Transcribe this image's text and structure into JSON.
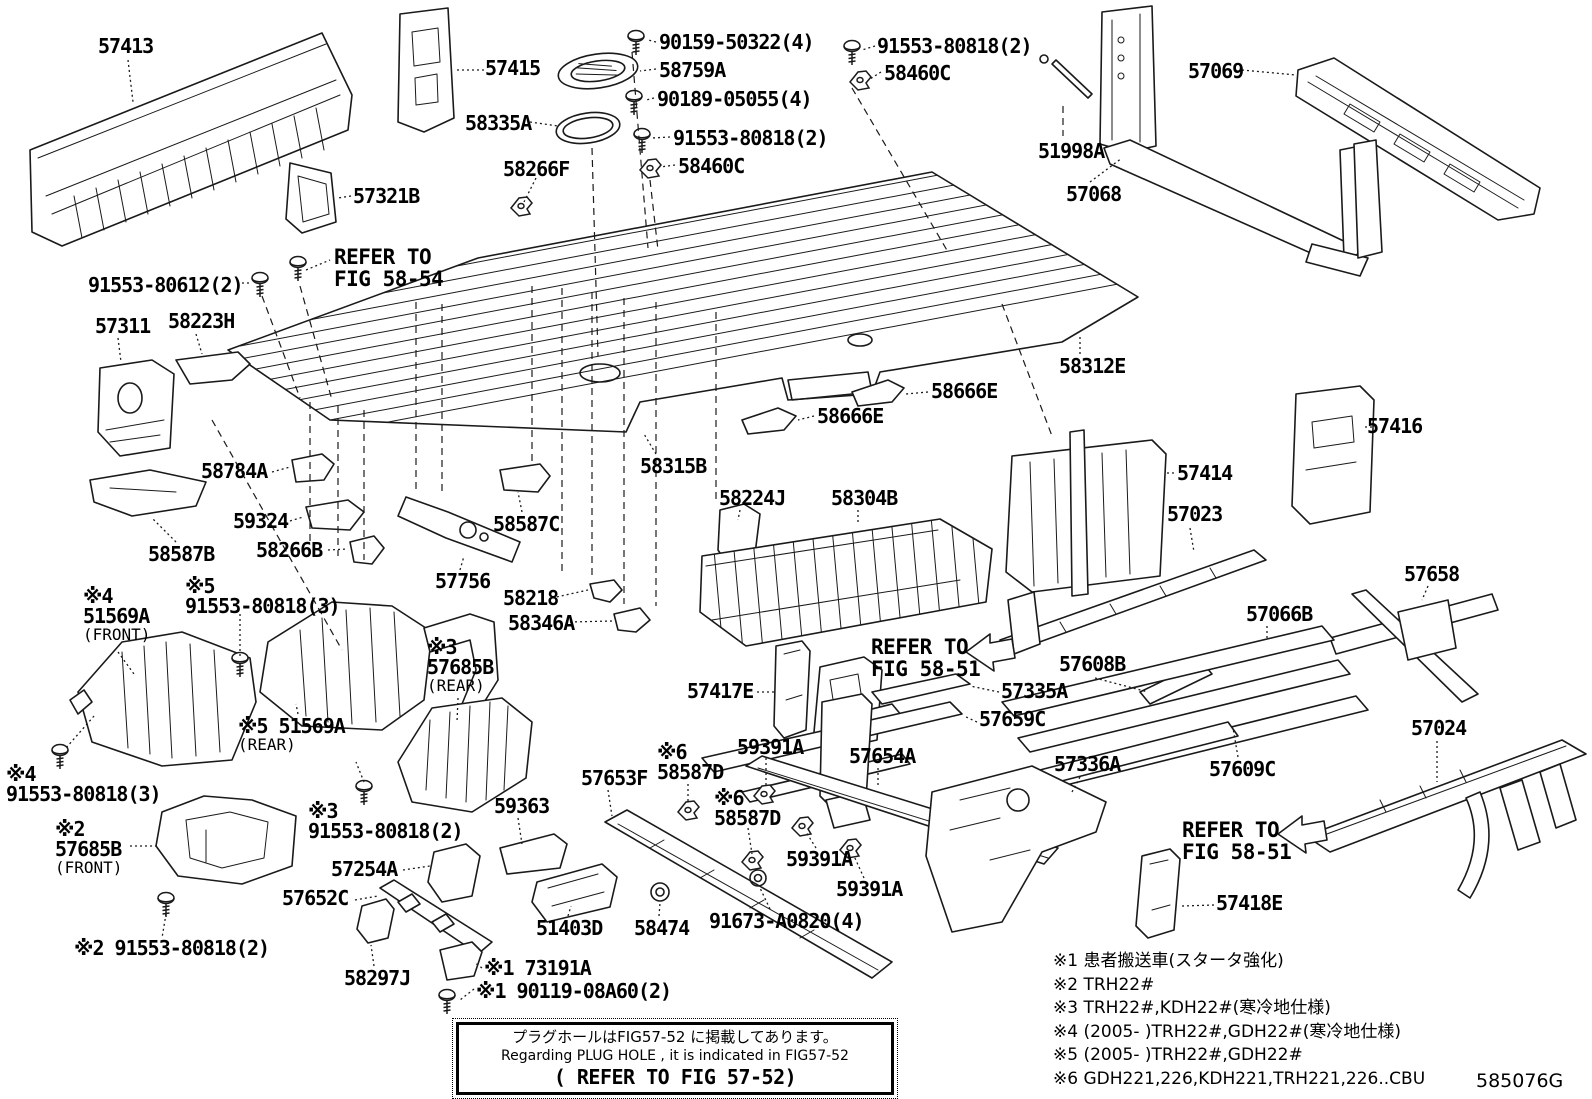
{
  "figure": {
    "code": "585076G"
  },
  "style": {
    "line_color": "#1a1a1a",
    "background": "#ffffff",
    "text_color": "#000000"
  },
  "callouts": [
    {
      "id": "57413",
      "lines": [
        "57413"
      ],
      "x": 98,
      "y": 36
    },
    {
      "id": "57415",
      "lines": [
        "57415"
      ],
      "x": 485,
      "y": 58
    },
    {
      "id": "90159-50322",
      "lines": [
        "90159-50322(4)"
      ],
      "x": 659,
      "y": 32
    },
    {
      "id": "58759A",
      "lines": [
        "58759A"
      ],
      "x": 659,
      "y": 60
    },
    {
      "id": "90189-05055",
      "lines": [
        "90189-05055(4)"
      ],
      "x": 657,
      "y": 89
    },
    {
      "id": "91553-80818-mid",
      "lines": [
        "91553-80818(2)"
      ],
      "x": 673,
      "y": 128
    },
    {
      "id": "58460C-mid",
      "lines": [
        "58460C"
      ],
      "x": 678,
      "y": 156
    },
    {
      "id": "91553-80818-tr",
      "lines": [
        "91553-80818(2)"
      ],
      "x": 877,
      "y": 36
    },
    {
      "id": "58460C-tr",
      "lines": [
        "58460C"
      ],
      "x": 884,
      "y": 63
    },
    {
      "id": "58335A",
      "lines": [
        "58335A"
      ],
      "x": 465,
      "y": 113
    },
    {
      "id": "58266F",
      "lines": [
        "58266F"
      ],
      "x": 503,
      "y": 159
    },
    {
      "id": "57321B",
      "lines": [
        "57321B"
      ],
      "x": 353,
      "y": 186
    },
    {
      "id": "57069",
      "lines": [
        "57069"
      ],
      "x": 1188,
      "y": 61
    },
    {
      "id": "51998A",
      "lines": [
        "51998A"
      ],
      "x": 1038,
      "y": 141
    },
    {
      "id": "57068",
      "lines": [
        "57068"
      ],
      "x": 1066,
      "y": 184
    },
    {
      "id": "91553-80612",
      "lines": [
        "91553-80612(2)"
      ],
      "x": 88,
      "y": 275
    },
    {
      "id": "57311",
      "lines": [
        "57311"
      ],
      "x": 95,
      "y": 316
    },
    {
      "id": "58223H",
      "lines": [
        "58223H"
      ],
      "x": 168,
      "y": 311
    },
    {
      "id": "58784A",
      "lines": [
        "58784A"
      ],
      "x": 201,
      "y": 461
    },
    {
      "id": "59324",
      "lines": [
        "59324"
      ],
      "x": 233,
      "y": 511
    },
    {
      "id": "58587B",
      "lines": [
        "58587B"
      ],
      "x": 148,
      "y": 544
    },
    {
      "id": "58266B",
      "lines": [
        "58266B"
      ],
      "x": 256,
      "y": 540
    },
    {
      "id": "58587C",
      "lines": [
        "58587C"
      ],
      "x": 493,
      "y": 514
    },
    {
      "id": "57756",
      "lines": [
        "57756"
      ],
      "x": 435,
      "y": 571
    },
    {
      "id": "58218",
      "lines": [
        "58218"
      ],
      "x": 503,
      "y": 588
    },
    {
      "id": "58346A",
      "lines": [
        "58346A"
      ],
      "x": 508,
      "y": 613
    },
    {
      "id": "58315B",
      "lines": [
        "58315B"
      ],
      "x": 640,
      "y": 456
    },
    {
      "id": "58666E-a",
      "lines": [
        "58666E"
      ],
      "x": 931,
      "y": 381
    },
    {
      "id": "58666E-b",
      "lines": [
        "58666E"
      ],
      "x": 817,
      "y": 406
    },
    {
      "id": "58312E",
      "lines": [
        "58312E"
      ],
      "x": 1059,
      "y": 356
    },
    {
      "id": "57416",
      "lines": [
        "57416"
      ],
      "x": 1367,
      "y": 416
    },
    {
      "id": "57414",
      "lines": [
        "57414"
      ],
      "x": 1177,
      "y": 463
    },
    {
      "id": "58224J",
      "lines": [
        "58224J"
      ],
      "x": 719,
      "y": 488
    },
    {
      "id": "58304B",
      "lines": [
        "58304B"
      ],
      "x": 831,
      "y": 488
    },
    {
      "id": "57023",
      "lines": [
        "57023"
      ],
      "x": 1167,
      "y": 504
    },
    {
      "id": "57066B",
      "lines": [
        "57066B"
      ],
      "x": 1246,
      "y": 604
    },
    {
      "id": "57658",
      "lines": [
        "57658"
      ],
      "x": 1404,
      "y": 564
    },
    {
      "id": "51569A-front",
      "lines": [
        "※4",
        "51569A",
        "(FRONT)"
      ],
      "x": 83,
      "y": 586
    },
    {
      "id": "91553-80818-3-mid",
      "lines": [
        "※5",
        "91553-80818(3)"
      ],
      "x": 185,
      "y": 576
    },
    {
      "id": "57685B-rear",
      "lines": [
        "※3",
        "57685B",
        "(REAR)"
      ],
      "x": 427,
      "y": 637
    },
    {
      "id": "51569A-rear",
      "lines": [
        "※5 51569A",
        "(REAR)"
      ],
      "x": 238,
      "y": 716
    },
    {
      "id": "91553-80818-3-bl",
      "lines": [
        "※4",
        "91553-80818(3)"
      ],
      "x": 6,
      "y": 764
    },
    {
      "id": "57685B-front",
      "lines": [
        "※2",
        "57685B",
        "(FRONT)"
      ],
      "x": 55,
      "y": 819
    },
    {
      "id": "91553-80818-2-b3",
      "lines": [
        "※3",
        "91553-80818(2)"
      ],
      "x": 308,
      "y": 801
    },
    {
      "id": "91553-80818-2-b2",
      "lines": [
        "※2 91553-80818(2)"
      ],
      "x": 74,
      "y": 938
    },
    {
      "id": "57254A",
      "lines": [
        "57254A"
      ],
      "x": 331,
      "y": 859
    },
    {
      "id": "57652C",
      "lines": [
        "57652C"
      ],
      "x": 282,
      "y": 888
    },
    {
      "id": "58297J",
      "lines": [
        "58297J"
      ],
      "x": 344,
      "y": 968
    },
    {
      "id": "73191A",
      "lines": [
        "※1 73191A"
      ],
      "x": 484,
      "y": 958
    },
    {
      "id": "90119-08A60",
      "lines": [
        "※1 90119-08A60(2)"
      ],
      "x": 476,
      "y": 981
    },
    {
      "id": "59363",
      "lines": [
        "59363"
      ],
      "x": 494,
      "y": 796
    },
    {
      "id": "51403D",
      "lines": [
        "51403D"
      ],
      "x": 536,
      "y": 918
    },
    {
      "id": "58474",
      "lines": [
        "58474"
      ],
      "x": 634,
      "y": 918
    },
    {
      "id": "91673-A0820",
      "lines": [
        "91673-A0820(4)"
      ],
      "x": 709,
      "y": 911
    },
    {
      "id": "57653F",
      "lines": [
        "57653F"
      ],
      "x": 581,
      "y": 768
    },
    {
      "id": "58587D-a",
      "lines": [
        "※6",
        "58587D"
      ],
      "x": 657,
      "y": 742
    },
    {
      "id": "58587D-b",
      "lines": [
        "※6",
        "58587D"
      ],
      "x": 714,
      "y": 788
    },
    {
      "id": "59391A-a",
      "lines": [
        "59391A"
      ],
      "x": 737,
      "y": 737
    },
    {
      "id": "57654A",
      "lines": [
        "57654A"
      ],
      "x": 849,
      "y": 746
    },
    {
      "id": "59391A-b",
      "lines": [
        "59391A"
      ],
      "x": 786,
      "y": 849
    },
    {
      "id": "59391A-c",
      "lines": [
        "59391A"
      ],
      "x": 836,
      "y": 879
    },
    {
      "id": "57417E",
      "lines": [
        "57417E"
      ],
      "x": 687,
      "y": 681
    },
    {
      "id": "57335A",
      "lines": [
        "57335A"
      ],
      "x": 1001,
      "y": 681
    },
    {
      "id": "57659C",
      "lines": [
        "57659C"
      ],
      "x": 979,
      "y": 709
    },
    {
      "id": "57608B",
      "lines": [
        "57608B"
      ],
      "x": 1059,
      "y": 654
    },
    {
      "id": "57336A",
      "lines": [
        "57336A"
      ],
      "x": 1054,
      "y": 754
    },
    {
      "id": "57609C",
      "lines": [
        "57609C"
      ],
      "x": 1209,
      "y": 759
    },
    {
      "id": "57024",
      "lines": [
        "57024"
      ],
      "x": 1411,
      "y": 718
    },
    {
      "id": "57418E",
      "lines": [
        "57418E"
      ],
      "x": 1216,
      "y": 893
    }
  ],
  "refer_notes": [
    {
      "id": "refer-fig-58-54",
      "lines": [
        "REFER TO",
        "FIG 58-54"
      ],
      "x": 334,
      "y": 246
    },
    {
      "id": "refer-fig-58-51-a",
      "lines": [
        "REFER TO",
        "FIG 58-51"
      ],
      "x": 871,
      "y": 636
    },
    {
      "id": "refer-fig-58-51-b",
      "lines": [
        "REFER TO",
        "FIG 58-51"
      ],
      "x": 1182,
      "y": 819
    }
  ],
  "notes": [
    "※1 患者搬送車(スタータ強化)",
    "※2 TRH22#",
    "※3 TRH22#,KDH22#(寒冷地仕様)",
    "※4 (2005-      )TRH22#,GDH22#(寒冷地仕様)",
    "※5 (2005-      )TRH22#,GDH22#",
    "※6 GDH221,226,KDH221,TRH221,226..CBU"
  ],
  "plug_hole_box": {
    "jp": "プラグホールはFIG57-52 に掲載してあります。",
    "en": "Regarding PLUG HOLE , it is indicated in FIG57-52",
    "refer": "( REFER TO FIG 57-52)"
  }
}
